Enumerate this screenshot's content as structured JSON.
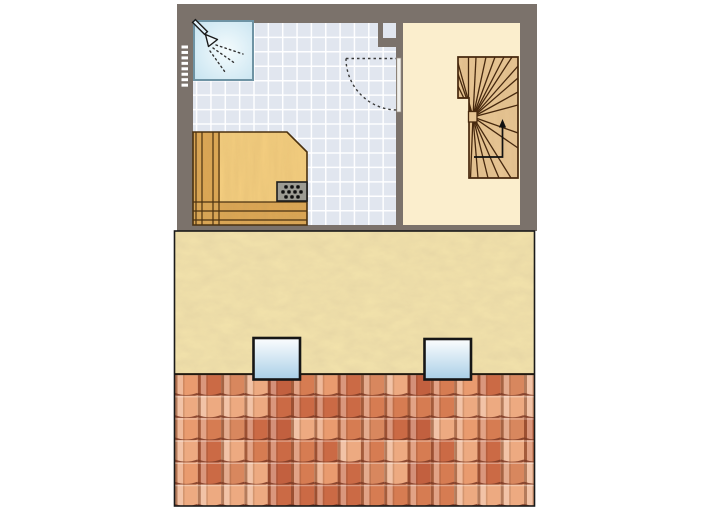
{
  "scene": {
    "width": 713,
    "height": 519,
    "background": "#ffffff",
    "description": "attic floor plan above roof elevation"
  },
  "floor_plan": {
    "frame": {
      "x": 177,
      "y": 4,
      "w": 360,
      "h": 227,
      "wall_color": "#7b726b"
    },
    "bathroom": {
      "x": 193,
      "y": 23,
      "w": 203,
      "h": 202,
      "floor_color": "#e1e6ef",
      "grout_color": "#ffffff",
      "tile_size_x": 14.35,
      "tile_size_y": 14.45,
      "grid_offset_x": 196.6,
      "grid_offset_y": 22.9
    },
    "stairwell_room": {
      "x": 403,
      "y": 23,
      "w": 117,
      "h": 202,
      "floor_color": "#fbeecd"
    },
    "divider_wall": {
      "x": 396,
      "w": 7,
      "top_seg": [
        23,
        58
      ],
      "bottom_seg": [
        113,
        225
      ]
    },
    "niche": {
      "pier": [
        378,
        23,
        25,
        24
      ],
      "recess": [
        383,
        23,
        13,
        15
      ]
    },
    "shower": {
      "x": 194,
      "y": 21,
      "w": 59,
      "h": 59,
      "border_color": "#6e93a4",
      "fill_center": "#f4fbfd",
      "fill_edge": "#c6e3f0",
      "icon": "shower-head-icon",
      "spray_line_count": 3,
      "spray_lines": [
        [
          216,
          45,
          243,
          54
        ],
        [
          213,
          48,
          236,
          64
        ],
        [
          210,
          51,
          225,
          72
        ]
      ]
    },
    "vent_ticks": {
      "x": 181.5,
      "y0": 45.5,
      "count": 8,
      "w": 6.5,
      "h": 3,
      "step": 5.45,
      "color": "#ffffff"
    },
    "door": {
      "leaf": [
        396.8,
        58,
        4.2,
        54
      ],
      "leaf_color": "#f1f0ec",
      "hinge": [
        397,
        58.5
      ],
      "radius": 51.5,
      "arc_color": "#3a3a3a",
      "chord": [
        346,
        58.5,
        396,
        58.5
      ]
    },
    "sauna": {
      "poly": "193,132 287,132 307,152 307,225 193,225",
      "platform_color": "#f2cc7e",
      "wood_color": "#dca755",
      "line_color": "#4a3110",
      "strip_right": 220,
      "v_lines": [
        196,
        202,
        213,
        219
      ],
      "band_top": 202,
      "h_lines": [
        202,
        211,
        220
      ],
      "heater": {
        "x": 277,
        "y": 182,
        "w": 30,
        "h": 19,
        "fill": "#9c9b93",
        "border": "#1c1c1c",
        "dot_rows": [
          3,
          4,
          3
        ],
        "dot_color": "#0f0f0f"
      }
    },
    "stairs": {
      "wood_color": "#e6c493",
      "line_color": "#46280e",
      "outline": "458,57 518,57 518,178 469,178 469,98 458,98",
      "center": [
        473,
        117
      ],
      "strip_divider_x": 468.5,
      "strip_bottom_y": 98,
      "fan_left_y": [
        63,
        74,
        86
      ],
      "fan_top_x": [
        476,
        486,
        495,
        504,
        512
      ],
      "fan_right_y": [
        66,
        78,
        92,
        105,
        133,
        148
      ],
      "fan_bottom_x": [
        511,
        499,
        488,
        478,
        470.5
      ],
      "newel": [
        468.5,
        111.5,
        8.5,
        10.5
      ],
      "walk_line": "474,157 502.5,157 502.5,126",
      "arrow_tip": [
        502.5,
        119
      ]
    }
  },
  "elevation": {
    "frame": {
      "x": 174.5,
      "y": 231,
      "w": 360,
      "h": 275,
      "border_color": "#1a1a1a"
    },
    "stucco": {
      "y": 231,
      "h": 142.5,
      "base_color": "#f2e2ab",
      "texture_color": "#b89a5e"
    },
    "roof": {
      "y": 373.5,
      "h": 132.5,
      "rows": 6,
      "cols": 16,
      "tile_w": 23.3,
      "tile_h": 22.2,
      "palette": [
        "#e99b6f",
        "#d67c52",
        "#c2603f",
        "#edaa81",
        "#d8875e",
        "#cb6a45"
      ],
      "shadow_color": "#7c3a24",
      "top_line_color": "#221a10"
    },
    "skylights": [
      {
        "x": 253.5,
        "y": 338,
        "w": 46.5,
        "h": 41.5
      },
      {
        "x": 424.5,
        "y": 339,
        "w": 46.5,
        "h": 40.5
      }
    ],
    "skylight_style": {
      "border_color": "#161616",
      "fill_top": "#fcfdfe",
      "fill_bottom": "#a9cfe7"
    }
  }
}
